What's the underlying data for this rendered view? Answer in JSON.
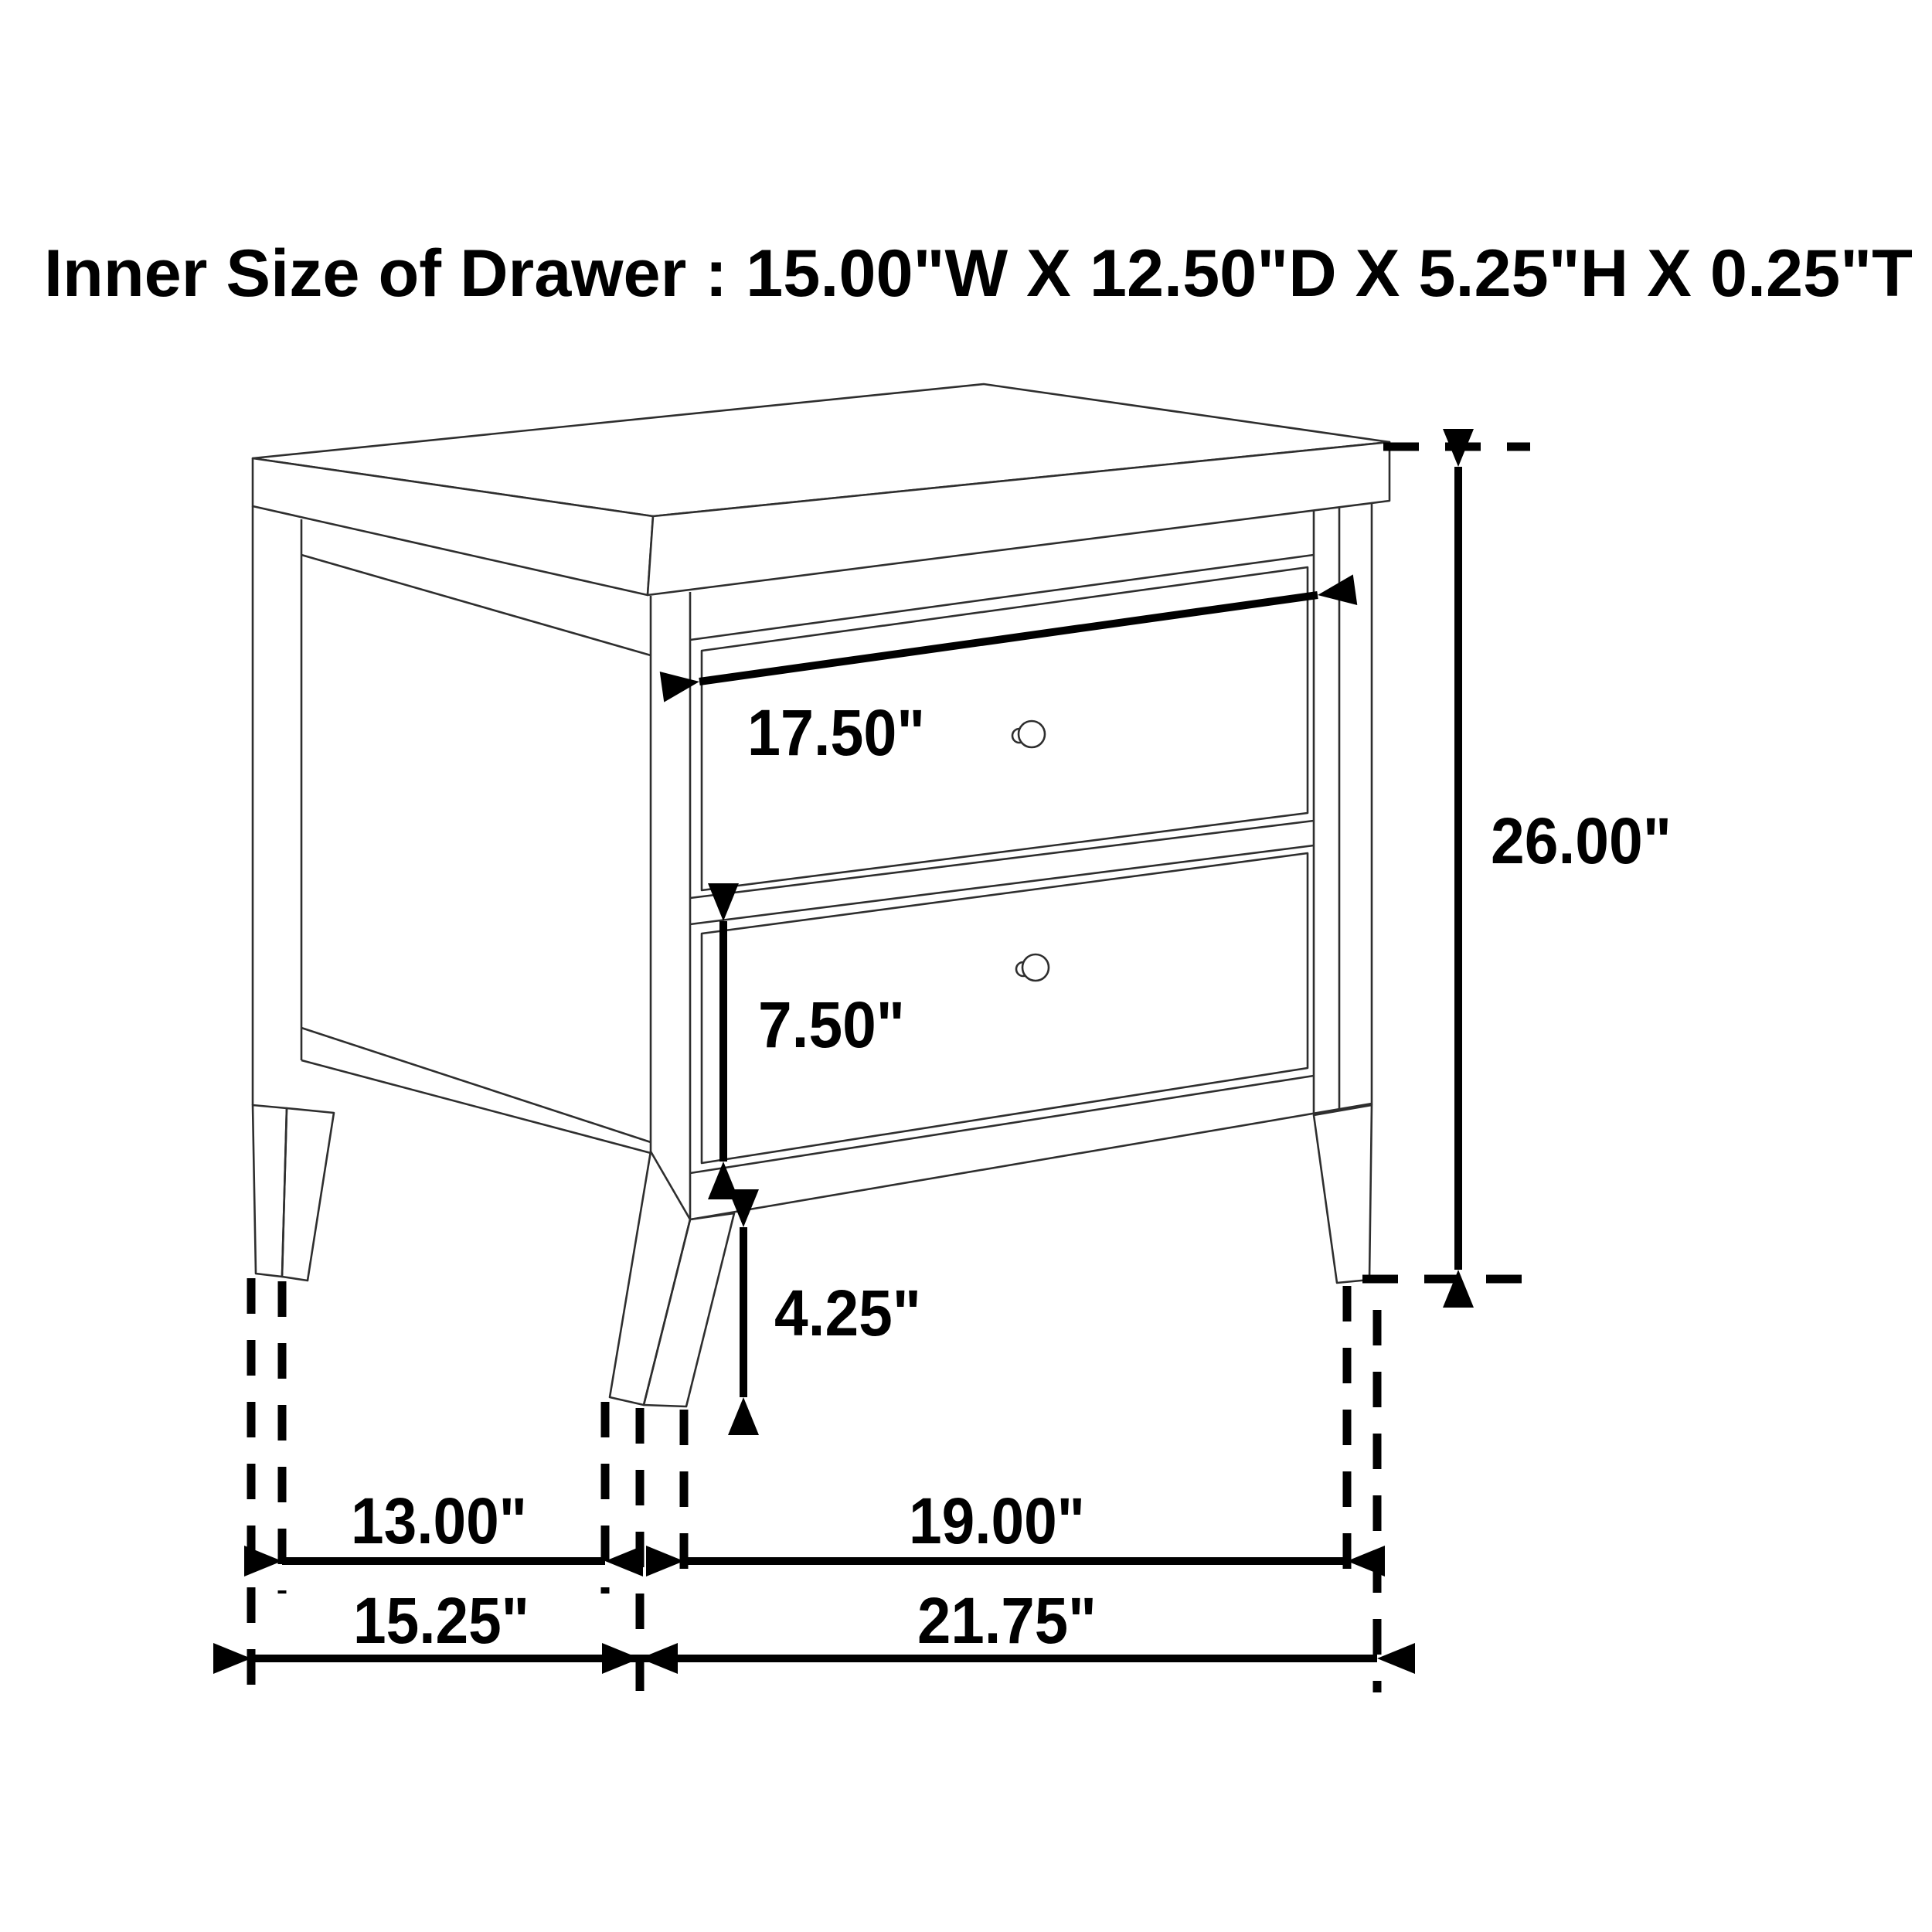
{
  "title": "Inner Size of Drawer : 15.00\"W X 12.50\"D X 5.25\"H X 0.25\"T",
  "inner_drawer": {
    "width": "15.00\"W",
    "depth": "12.50\"D",
    "height": "5.25\"H",
    "thickness": "0.25\"T"
  },
  "colors": {
    "background": "#ffffff",
    "furniture_line": "#2e2e2e",
    "dimension": "#000000"
  },
  "dimensions": {
    "drawer_width": {
      "label": "17.50\"",
      "value": 17.5,
      "unit": "in"
    },
    "drawer_front_height": {
      "label": "7.50\"",
      "value": 7.5,
      "unit": "in"
    },
    "floor_clearance": {
      "label": "4.25\"",
      "value": 4.25,
      "unit": "in"
    },
    "overall_height": {
      "label": "26.00\"",
      "value": 26.0,
      "unit": "in"
    },
    "depth_between_legs": {
      "label": "13.00\"",
      "value": 13.0,
      "unit": "in"
    },
    "width_between_legs": {
      "label": "19.00\"",
      "value": 19.0,
      "unit": "in"
    },
    "overall_depth": {
      "label": "15.25\"",
      "value": 15.25,
      "unit": "in"
    },
    "overall_width": {
      "label": "21.75\"",
      "value": 21.75,
      "unit": "in"
    }
  }
}
